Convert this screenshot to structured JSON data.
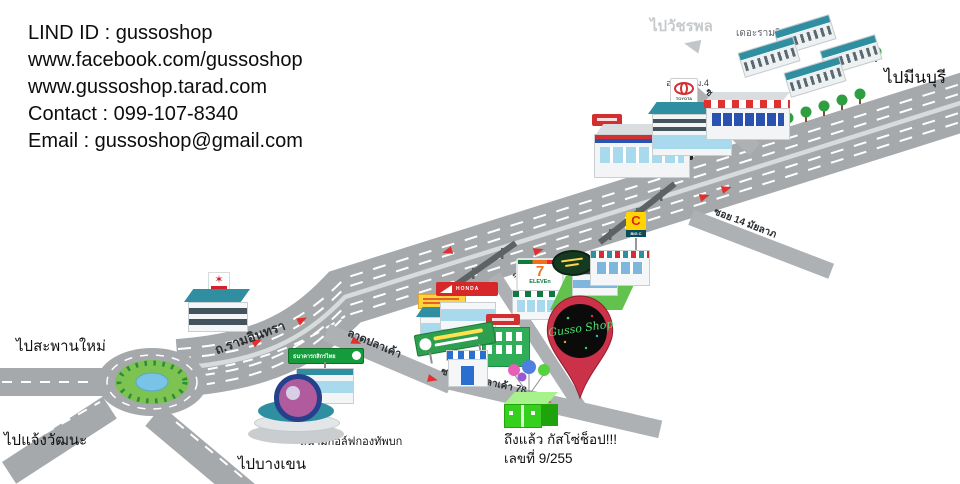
{
  "contact": {
    "line1": "LIND ID : gussoshop",
    "line2": "www.facebook.com/gussoshop",
    "line3": "www.gussoshop.tarad.com",
    "line4": "Contact : 099-107-8340",
    "line5": "Email : gussoshop@gmail.com"
  },
  "directions": {
    "watcharaphon": "ไปวัชรพล",
    "min_buri": "ไปมีนบุรี",
    "saphan_mai": "ไปสะพานใหม่",
    "chaeng_watthana": "ไปแจ้งวัฒนะ",
    "bang_khen": "ไปบางเขน"
  },
  "roads": {
    "ram_inthra": "ถ.รามอินทรา",
    "soi_39": "ซอย 39",
    "soi_14": "ซอย 14 มัยลาภ",
    "lat_pla_khao": "ลาดปลาเค้า",
    "lat_pla_khao_branch": "ถนนลาดปลาเค้า",
    "soi_78": "ซอย ลาดปลาเค้า 78"
  },
  "places": {
    "the_ram_inthra": "เดอะรามอินทรา",
    "km4_auto": "ออโต้ กม.4",
    "kasikorn_bank": "ธนาคารกสิกรไทย",
    "army_golf_course": "สนามกอล์ฟกองทัพบก",
    "seven_eleven_7": "7",
    "seven_eleven_text": "ELEVEn",
    "honda": "HONDA",
    "toyota": "TOYOTA",
    "big_c_letter": "C",
    "big_c_text": "BIG C"
  },
  "destination": {
    "pin_text": "Gusso Shop",
    "arrival": "ถึงแล้ว กัสโซ่ช็อป!!!",
    "address": "เลขที่ 9/255"
  },
  "colors": {
    "road_gray": "#a5a9ab",
    "pin_red": "#cb3148",
    "pin_logo_green": "#4be06e",
    "shop_green": "#35cf1d",
    "route_arrow_red": "#e03131",
    "kasikorn_green": "#169b3c",
    "seven_eleven_green": "#0f7a40",
    "seven_eleven_orange": "#f26f21",
    "honda_red": "#d62828",
    "toyota_red": "#d23030",
    "big_c_yellow": "#ffd400",
    "roof_teal": "#2f8fa0"
  }
}
